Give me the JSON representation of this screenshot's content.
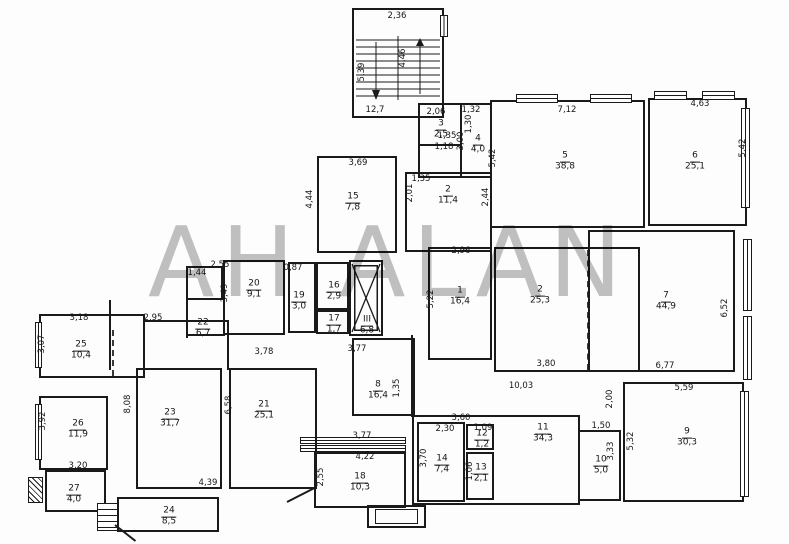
{
  "watermark": "АН ALAN",
  "plan": {
    "rooms": [
      {
        "n": "3",
        "a": "2,5",
        "x": 441,
        "y": 126
      },
      {
        "n": "4",
        "a": "4,0",
        "x": 478,
        "y": 141
      },
      {
        "n": "5",
        "a": "38,8",
        "x": 565,
        "y": 158
      },
      {
        "n": "6",
        "a": "25,1",
        "x": 695,
        "y": 158
      },
      {
        "n": "15",
        "a": "7,8",
        "x": 353,
        "y": 199
      },
      {
        "n": "2",
        "a": "11,4",
        "x": 448,
        "y": 192
      },
      {
        "n": "20",
        "a": "9,1",
        "x": 254,
        "y": 286
      },
      {
        "n": "19",
        "a": "3,0",
        "x": 299,
        "y": 298
      },
      {
        "n": "16",
        "a": "2,9",
        "x": 334,
        "y": 288
      },
      {
        "n": "17",
        "a": "1,7",
        "x": 334,
        "y": 321
      },
      {
        "n": "22",
        "a": "6,7",
        "x": 203,
        "y": 325
      },
      {
        "n": "III",
        "a": "6,8",
        "x": 367,
        "y": 322
      },
      {
        "n": "1",
        "a": "16,4",
        "x": 460,
        "y": 293
      },
      {
        "n": "2",
        "a": "25,3",
        "x": 540,
        "y": 292
      },
      {
        "n": "7",
        "a": "44,9",
        "x": 666,
        "y": 298
      },
      {
        "n": "8",
        "a": "16,4",
        "x": 378,
        "y": 387
      },
      {
        "n": "9",
        "a": "30,3",
        "x": 687,
        "y": 434
      },
      {
        "n": "10",
        "a": "5,0",
        "x": 601,
        "y": 462
      },
      {
        "n": "11",
        "a": "34,3",
        "x": 543,
        "y": 430
      },
      {
        "n": "12",
        "a": "1,2",
        "x": 482,
        "y": 436
      },
      {
        "n": "13",
        "a": "2,1",
        "x": 481,
        "y": 470
      },
      {
        "n": "14",
        "a": "7,4",
        "x": 442,
        "y": 461
      },
      {
        "n": "18",
        "a": "10,3",
        "x": 360,
        "y": 479
      },
      {
        "n": "21",
        "a": "25,1",
        "x": 264,
        "y": 407
      },
      {
        "n": "23",
        "a": "31,7",
        "x": 170,
        "y": 415
      },
      {
        "n": "25",
        "a": "10,4",
        "x": 81,
        "y": 347
      },
      {
        "n": "26",
        "a": "11,9",
        "x": 78,
        "y": 426
      },
      {
        "n": "27",
        "a": "4,0",
        "x": 74,
        "y": 491
      },
      {
        "n": "24",
        "a": "8,5",
        "x": 169,
        "y": 513
      }
    ],
    "dims": [
      {
        "t": "2,36",
        "x": 397,
        "y": 16
      },
      {
        "t": "5,39",
        "x": 362,
        "y": 72,
        "r": 1
      },
      {
        "t": "4,46",
        "x": 403,
        "y": 58,
        "r": 1
      },
      {
        "t": "12,7",
        "x": 375,
        "y": 110
      },
      {
        "t": "2,06",
        "x": 436,
        "y": 112
      },
      {
        "t": "1,30",
        "x": 469,
        "y": 124,
        "r": 1
      },
      {
        "t": "1,35",
        "x": 447,
        "y": 136
      },
      {
        "t": "1,18",
        "x": 444,
        "y": 147
      },
      {
        "t": "1,32",
        "x": 471,
        "y": 110
      },
      {
        "t": "3,00",
        "x": 461,
        "y": 141,
        "r": 1
      },
      {
        "t": "7,12",
        "x": 567,
        "y": 110
      },
      {
        "t": "4,63",
        "x": 700,
        "y": 104
      },
      {
        "t": "5,42",
        "x": 743,
        "y": 148,
        "r": 1
      },
      {
        "t": "5,42",
        "x": 493,
        "y": 158,
        "r": 1
      },
      {
        "t": "2,44",
        "x": 486,
        "y": 197,
        "r": 1
      },
      {
        "t": "2,01",
        "x": 410,
        "y": 193,
        "r": 1
      },
      {
        "t": "1,35",
        "x": 421,
        "y": 179
      },
      {
        "t": "3,69",
        "x": 358,
        "y": 163
      },
      {
        "t": "4,44",
        "x": 310,
        "y": 199,
        "r": 1
      },
      {
        "t": "2,96",
        "x": 461,
        "y": 251
      },
      {
        "t": "2,55",
        "x": 220,
        "y": 265
      },
      {
        "t": "0,87",
        "x": 293,
        "y": 268
      },
      {
        "t": "1,44",
        "x": 197,
        "y": 273
      },
      {
        "t": "3,49",
        "x": 225,
        "y": 293,
        "r": 1
      },
      {
        "t": "5,22",
        "x": 431,
        "y": 299,
        "r": 1
      },
      {
        "t": "6,52",
        "x": 725,
        "y": 308,
        "r": 1
      },
      {
        "t": "3,80",
        "x": 546,
        "y": 364
      },
      {
        "t": "6,77",
        "x": 665,
        "y": 366
      },
      {
        "t": "3,78",
        "x": 264,
        "y": 352
      },
      {
        "t": "3,77",
        "x": 357,
        "y": 349
      },
      {
        "t": "10,03",
        "x": 521,
        "y": 386
      },
      {
        "t": "2,00",
        "x": 610,
        "y": 399,
        "r": 1
      },
      {
        "t": "1,50",
        "x": 601,
        "y": 426
      },
      {
        "t": "5,59",
        "x": 684,
        "y": 388
      },
      {
        "t": "5,32",
        "x": 631,
        "y": 441,
        "r": 1
      },
      {
        "t": "3,33",
        "x": 611,
        "y": 451,
        "r": 1
      },
      {
        "t": "3,60",
        "x": 461,
        "y": 418
      },
      {
        "t": "2,30",
        "x": 445,
        "y": 429
      },
      {
        "t": "1,09",
        "x": 483,
        "y": 428
      },
      {
        "t": "3,70",
        "x": 424,
        "y": 458,
        "r": 1
      },
      {
        "t": "1,06",
        "x": 470,
        "y": 471,
        "r": 1
      },
      {
        "t": "4,22",
        "x": 365,
        "y": 457
      },
      {
        "t": "3,77",
        "x": 362,
        "y": 436
      },
      {
        "t": "2,55",
        "x": 321,
        "y": 477,
        "r": 1
      },
      {
        "t": "6,58",
        "x": 229,
        "y": 405,
        "r": 1
      },
      {
        "t": "8,08",
        "x": 128,
        "y": 404,
        "r": 1
      },
      {
        "t": "4,39",
        "x": 208,
        "y": 483
      },
      {
        "t": "3,20",
        "x": 78,
        "y": 466
      },
      {
        "t": "3,92",
        "x": 43,
        "y": 421,
        "r": 1
      },
      {
        "t": "3,18",
        "x": 79,
        "y": 318
      },
      {
        "t": "3,07",
        "x": 42,
        "y": 344,
        "r": 1
      },
      {
        "t": "2,95",
        "x": 153,
        "y": 318
      },
      {
        "t": "1,35",
        "x": 397,
        "y": 388,
        "r": 1
      }
    ]
  }
}
